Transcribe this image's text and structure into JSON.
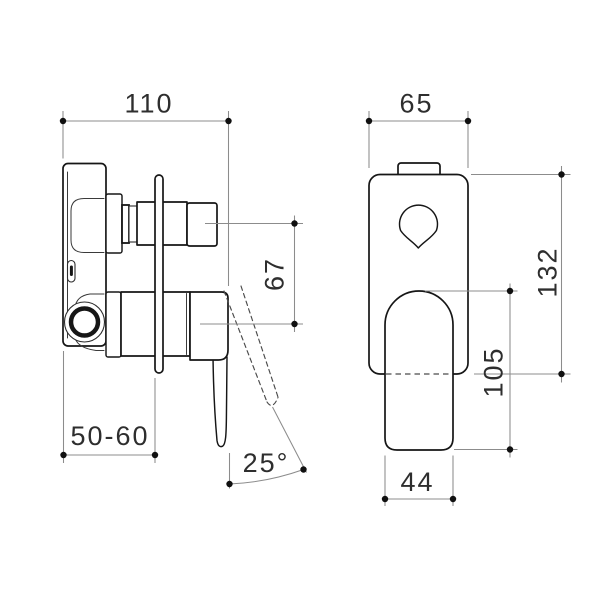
{
  "drawing": {
    "colors": {
      "background": "#ffffff",
      "object_line": "#161616",
      "dimension_line": "#8c8c8c",
      "text": "#2e2e2e"
    },
    "side_view": {
      "dims": {
        "overall_depth": "110",
        "outlet_spacing": "67",
        "wall_depth_range": "50-60",
        "handle_angle": "25°"
      }
    },
    "front_view": {
      "dims": {
        "plate_width": "65",
        "plate_height": "132",
        "handle_length": "105",
        "handle_width": "44"
      }
    }
  }
}
